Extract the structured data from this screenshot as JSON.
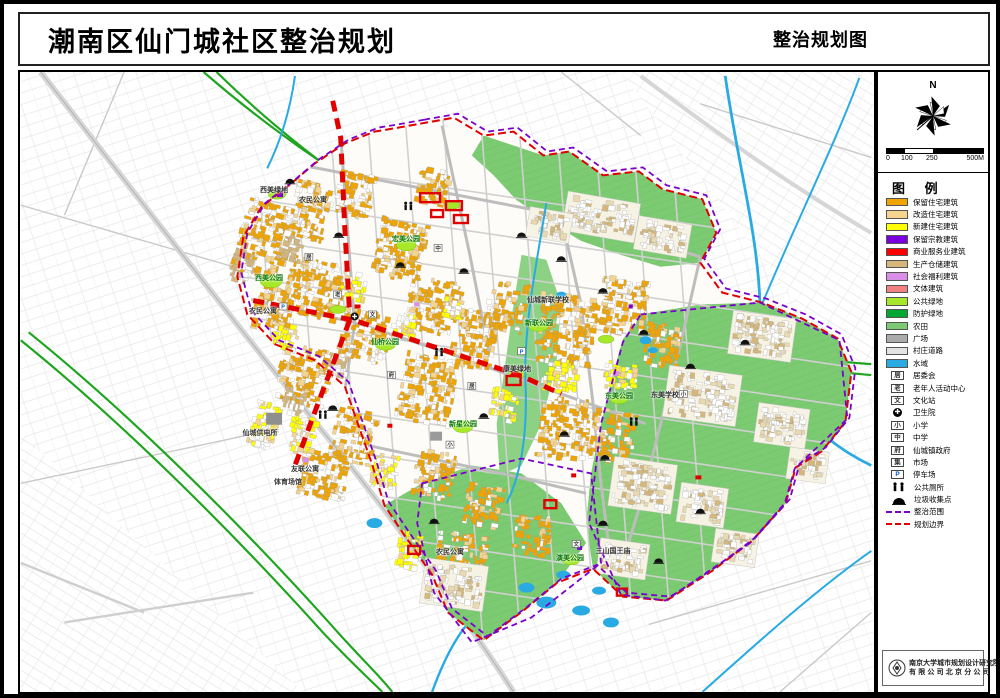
{
  "title": {
    "main": "潮南区仙门城社区整治规划",
    "right": "整治规划图"
  },
  "compass": {
    "north_label": "N"
  },
  "scalebar": {
    "ticks": [
      "0",
      "100",
      "250",
      "500M"
    ]
  },
  "legend": {
    "title": "图 例",
    "swatches": [
      {
        "label": "保留住宅建筑",
        "color": "#f0a400"
      },
      {
        "label": "改造住宅建筑",
        "color": "#f5d490"
      },
      {
        "label": "新建住宅建筑",
        "color": "#ffff00"
      },
      {
        "label": "保留宗教建筑",
        "color": "#7b00e0"
      },
      {
        "label": "商业服务业建筑",
        "color": "#ff0000"
      },
      {
        "label": "生产仓储建筑",
        "color": "#d6b77b"
      },
      {
        "label": "社会福利建筑",
        "color": "#d98fe8"
      },
      {
        "label": "文体建筑",
        "color": "#f28080"
      },
      {
        "label": "公共绿地",
        "color": "#a8e82a"
      },
      {
        "label": "防护绿地",
        "color": "#00a832"
      },
      {
        "label": "农田",
        "color": "#7ccb72"
      },
      {
        "label": "广场",
        "color": "#ababab"
      },
      {
        "label": "村庄道路",
        "color": "#e3e3e3"
      },
      {
        "label": "水域",
        "color": "#29aae3"
      }
    ],
    "icons": [
      {
        "label": "居委会",
        "glyph": "居",
        "type": "box"
      },
      {
        "label": "老年人活动中心",
        "glyph": "老",
        "type": "box"
      },
      {
        "label": "文化站",
        "glyph": "文",
        "type": "box"
      },
      {
        "label": "卫生院",
        "glyph": "✚",
        "type": "circle"
      },
      {
        "label": "小学",
        "glyph": "小",
        "type": "box"
      },
      {
        "label": "中学",
        "glyph": "中",
        "type": "box"
      },
      {
        "label": "仙城镇政府",
        "glyph": "府",
        "type": "box"
      },
      {
        "label": "市场",
        "glyph": "集",
        "type": "box"
      },
      {
        "label": "停车场",
        "glyph": "P",
        "type": "box"
      },
      {
        "label": "公共厕所",
        "glyph": "",
        "type": "toilet"
      },
      {
        "label": "垃圾收集点",
        "glyph": "",
        "type": "dome"
      }
    ],
    "lines": [
      {
        "label": "整治范围",
        "color": "#7a00cc"
      },
      {
        "label": "规划边界",
        "color": "#e00000"
      }
    ]
  },
  "map_labels": [
    {
      "text": "西美绿地",
      "x": 272,
      "y": 186,
      "c": "dark"
    },
    {
      "text": "农民公寓",
      "x": 311,
      "y": 196,
      "c": "dark"
    },
    {
      "text": "宏美公园",
      "x": 404,
      "y": 235,
      "c": "green"
    },
    {
      "text": "西美公园",
      "x": 267,
      "y": 274,
      "c": "green"
    },
    {
      "text": "农民公寓",
      "x": 261,
      "y": 307,
      "c": "dark"
    },
    {
      "text": "仙桥公园",
      "x": 383,
      "y": 338,
      "c": "green"
    },
    {
      "text": "仙城新联学校",
      "x": 546,
      "y": 296,
      "c": "dark"
    },
    {
      "text": "新联公园",
      "x": 537,
      "y": 319,
      "c": "green"
    },
    {
      "text": "康美绿地",
      "x": 515,
      "y": 365,
      "c": "dark"
    },
    {
      "text": "新星公园",
      "x": 461,
      "y": 420,
      "c": "green"
    },
    {
      "text": "东美公园",
      "x": 617,
      "y": 392,
      "c": "green"
    },
    {
      "text": "东美学校",
      "x": 663,
      "y": 391,
      "c": "dark"
    },
    {
      "text": "仙城供电所",
      "x": 258,
      "y": 429,
      "c": "dark"
    },
    {
      "text": "友联公寓",
      "x": 303,
      "y": 465,
      "c": "dark"
    },
    {
      "text": "体育场馆",
      "x": 286,
      "y": 478,
      "c": "dark"
    },
    {
      "text": "农民公寓",
      "x": 448,
      "y": 548,
      "c": "dark"
    },
    {
      "text": "演美公园",
      "x": 568,
      "y": 554,
      "c": "green"
    },
    {
      "text": "三山国王庙",
      "x": 611,
      "y": 547,
      "c": "dark"
    }
  ],
  "footer": {
    "line1": "南京大学城市规划设计研究院",
    "line2": "有限公司北京分公司"
  }
}
